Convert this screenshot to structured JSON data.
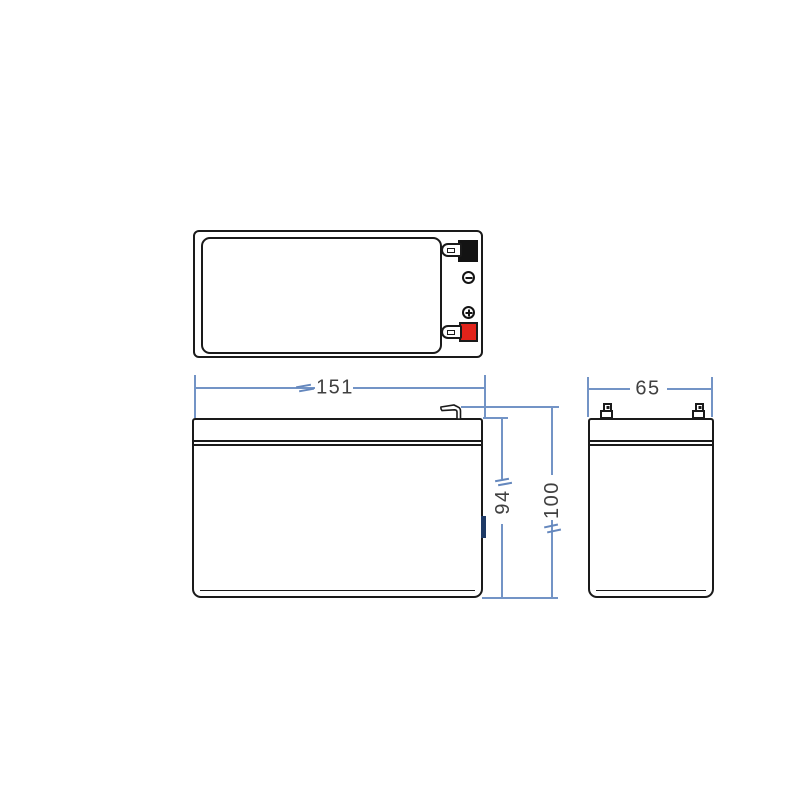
{
  "drawing": {
    "type": "battery-dimension-diagram",
    "views": {
      "top_view": "battery top view with terminals",
      "front_view": "battery front view",
      "side_view": "battery side view"
    },
    "dimensions": {
      "width_mm": "151",
      "case_height_mm": "94",
      "total_height_mm": "100",
      "depth_mm": "65"
    },
    "terminals": {
      "negative": {
        "symbol": "−",
        "color": "#131313"
      },
      "positive": {
        "symbol": "+",
        "color": "#e2231a"
      }
    },
    "colors": {
      "outline": "#1a1a1a",
      "dimension_line": "#7394c6",
      "label_text": "#404040",
      "side_marker": "#1e3a66",
      "background": "#ffffff"
    }
  }
}
